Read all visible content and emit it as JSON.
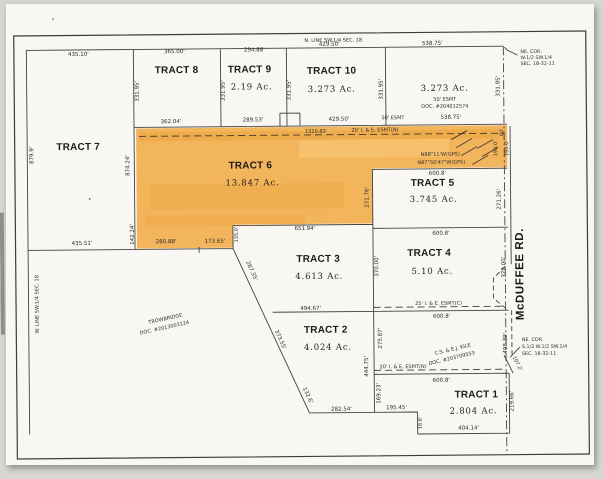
{
  "colors": {
    "highlight": "#f2a63b",
    "paper": "#f9f7f3",
    "ink": "#2b2a28",
    "background": "#d8d6d1"
  },
  "plat": {
    "north_line": "N. LINE SW.1/4 SEC. 18",
    "west_line": "W. LINE SW.1/4 SEC. 18",
    "road": "McDUFFEE RD.",
    "ne_corner": {
      "l1": "NE. COR.",
      "l2": "W.1/2 SW.1/4",
      "l3": "SEC. 18-32-11"
    },
    "se_corner": {
      "l1": "NE. COR.",
      "l2": "S.1/2 W.1/2 SW.1/4",
      "l3": "SEC. 18-32-11"
    }
  },
  "tracts": {
    "t1": {
      "name": "TRACT 1",
      "acres": "2.804 Ac."
    },
    "t2": {
      "name": "TRACT 2",
      "acres": "4.024 Ac."
    },
    "t3": {
      "name": "TRACT 3",
      "acres": "4.613 Ac."
    },
    "t4": {
      "name": "TRACT 4",
      "acres": "5.10 Ac."
    },
    "t5": {
      "name": "TRACT 5",
      "acres": "3.745 Ac."
    },
    "t6": {
      "name": "TRACT 6",
      "acres": "13.847 Ac."
    },
    "t7": {
      "name": "TRACT 7"
    },
    "t8": {
      "name": "TRACT 8"
    },
    "t9": {
      "name": "TRACT 9",
      "acres": "2.19 Ac."
    },
    "t10": {
      "name": "TRACT 10",
      "acres": "3.273 Ac."
    },
    "east_parcel": {
      "acres": "3.273 Ac.",
      "esmt": "50' ESMT",
      "doc": "DOC. #204012574"
    }
  },
  "owners": {
    "trowbridge": {
      "name": "TROWBRIDGE",
      "doc": "DOC. #2013003124"
    },
    "kile": {
      "name": "C.S. & E.J. KILE",
      "doc": "DOC. #203709553"
    }
  },
  "easements": {
    "north": "20' I. & E. ESMT(N)",
    "center": "25' I. & E. ESMT(C)",
    "south": "20' I. & E. ESMT(N)",
    "fifty": "50' ESMT"
  },
  "bearings": {
    "b1": "N88°11'W(GPS)",
    "b2": "N87°50'47\"W(GPS)"
  },
  "dims": {
    "t7_top": "435.10'",
    "t7_west": "879.9'",
    "t7_bottom": "435.51'",
    "t8_top": "365.00'",
    "t8_bottom": "362.04'",
    "t9_top": "294.88'",
    "t9_bottom": "289.53'",
    "t10_top": "429.50'",
    "t10_bottom": "429.50'",
    "ep_top": "538.75'",
    "ep_bottom": "538.75'",
    "v331": "331.95'",
    "strip": "1520.83'",
    "t6_west": "874.24'",
    "t6_west_lower": "142.24'",
    "t6_bot1": "280.88'",
    "t6_bot2": "173.65'",
    "t6_step": "135.0'",
    "d600": "600.8'",
    "t5_west": "271.76'",
    "t5_east": "271.26'",
    "t4_west": "370.00'",
    "t4_east": "370.00'",
    "t3_top": "651.94'",
    "t3_west": "267.35'",
    "t3_bottom": "494.67'",
    "t2_west_upper": "373.55'",
    "t2_west_lower": "132.6'",
    "t2_bottom": "282.54'",
    "t2_east": "444.75'",
    "kile_upper": "275.87'",
    "kile_lower": "169.23'",
    "t1_bottom": "404.14'",
    "t1_east": "219.66'",
    "south_195": "195.45'",
    "south_16": "16.6'",
    "road_60": "60'",
    "road_190": "190.0'",
    "road_498": "498.39'",
    "road_107": "107.2'"
  }
}
